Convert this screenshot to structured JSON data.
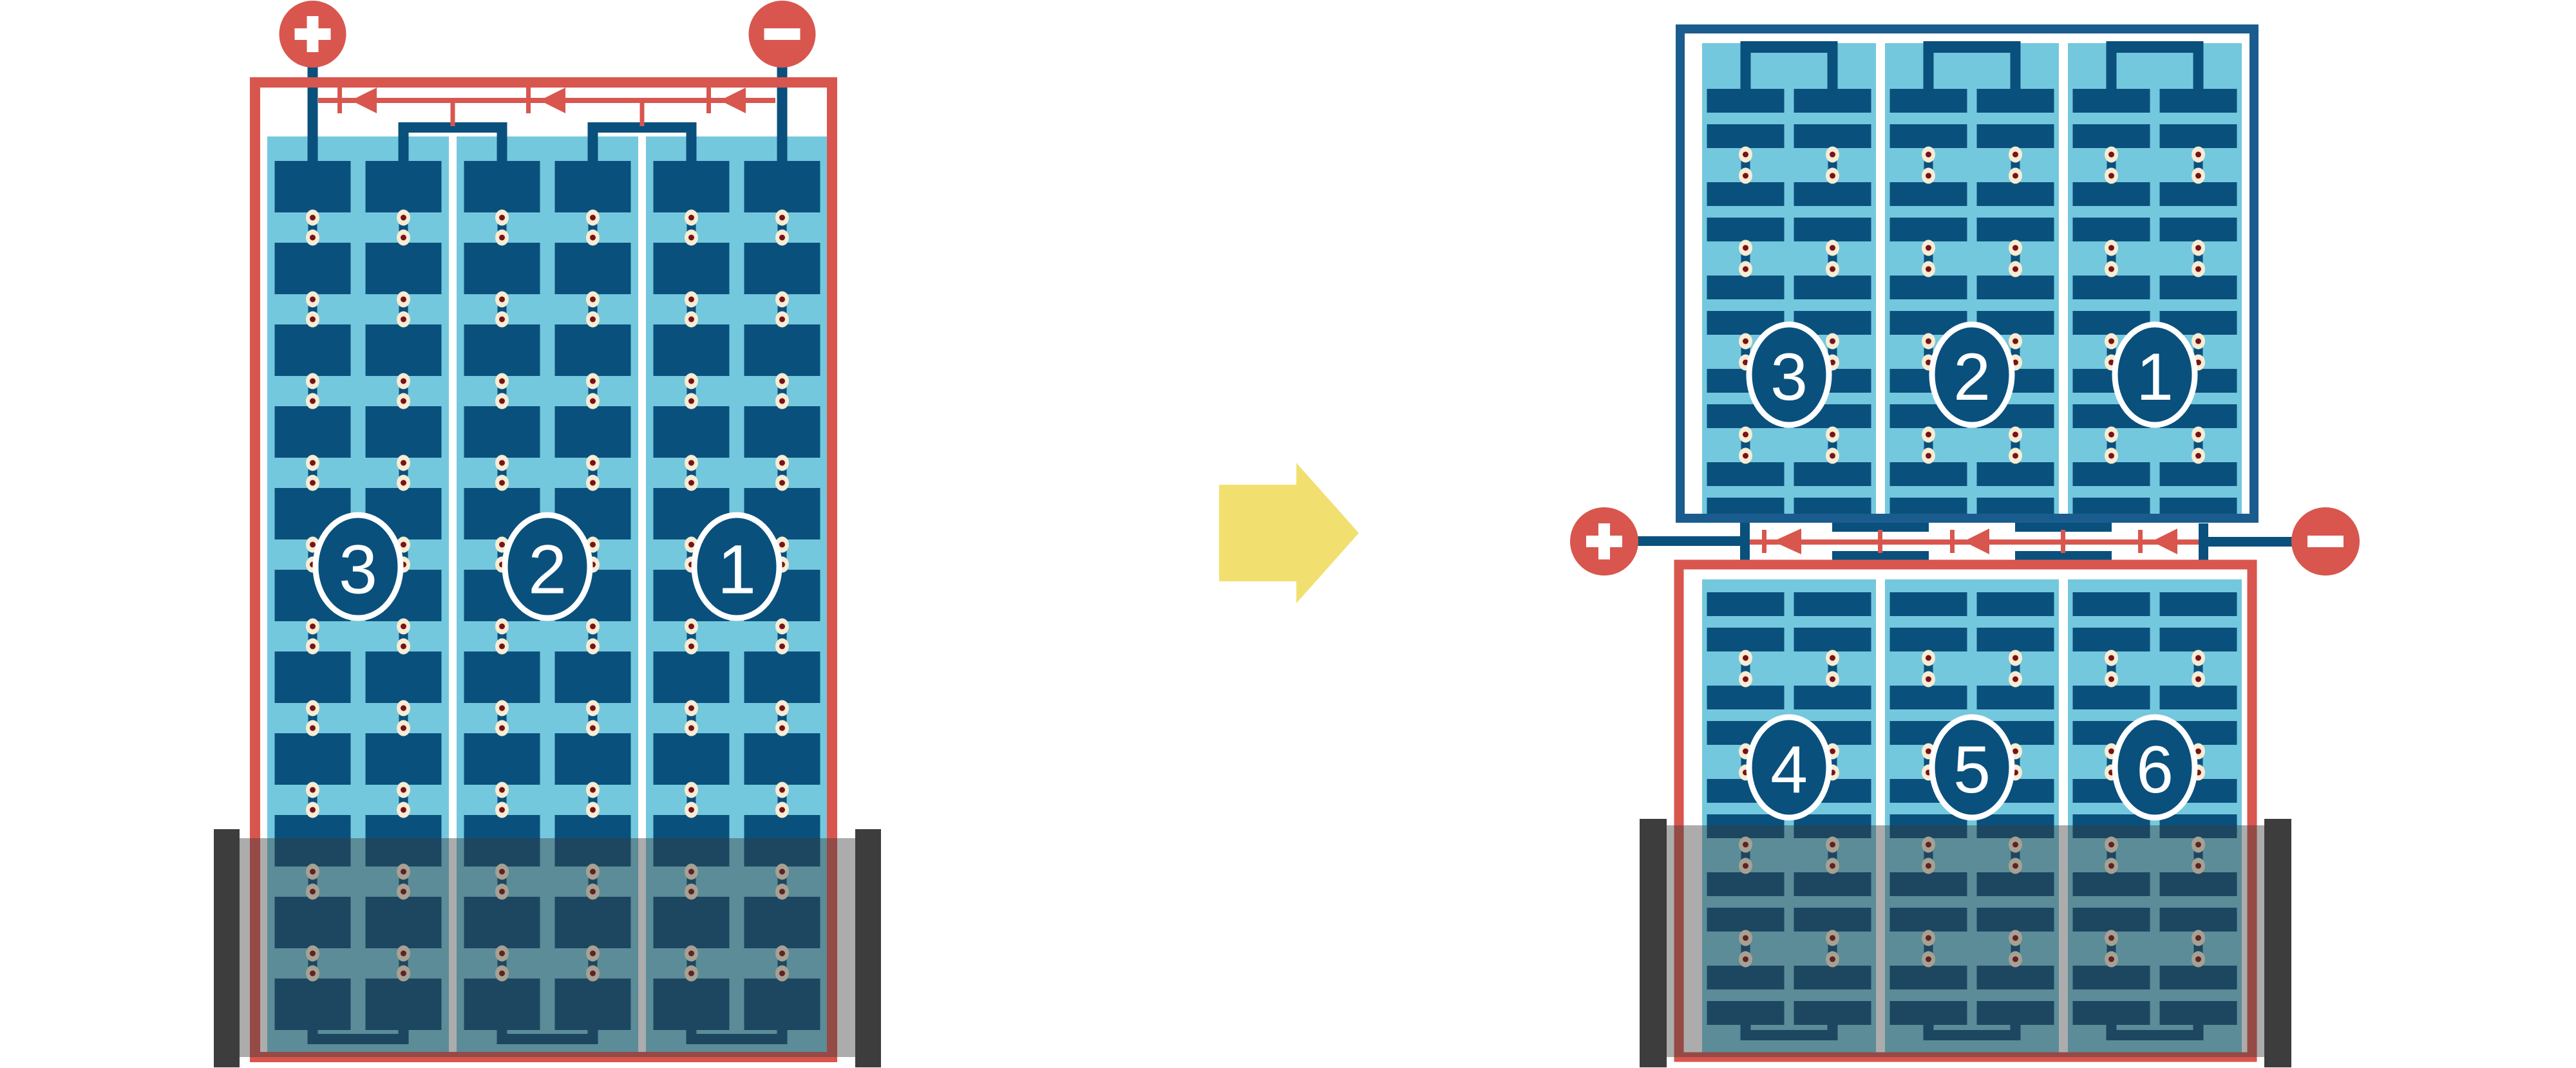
{
  "figure": {
    "kind": "battery-cell-wiring-diagram",
    "left_unit": {
      "cell_labels": [
        "3",
        "2",
        "1"
      ],
      "positive_symbol": "+",
      "negative_symbol": "−",
      "terminal_icons": [
        "plus-icon",
        "minus-icon"
      ],
      "current_arrow_direction": "left"
    },
    "transform_arrow_icon": "right-arrow-icon",
    "right_unit": {
      "upper_cell_labels": [
        "3",
        "2",
        "1"
      ],
      "lower_cell_labels": [
        "4",
        "5",
        "6"
      ],
      "positive_symbol": "+",
      "negative_symbol": "−",
      "terminal_icons": [
        "plus-icon",
        "minus-icon"
      ],
      "current_arrow_direction": "left"
    }
  },
  "colors": {
    "red": "#d8564e",
    "dark_blue": "#0a507d",
    "frame_blue": "#1b5c8e",
    "cyan": "#74c8dd",
    "rivet_cream": "#f7ecd4",
    "rivet_dot": "#7a1315",
    "yellow": "#f1e06f",
    "case_overlay": "rgba(58,58,58,0.42)",
    "case_end": "#3d3d3d"
  }
}
